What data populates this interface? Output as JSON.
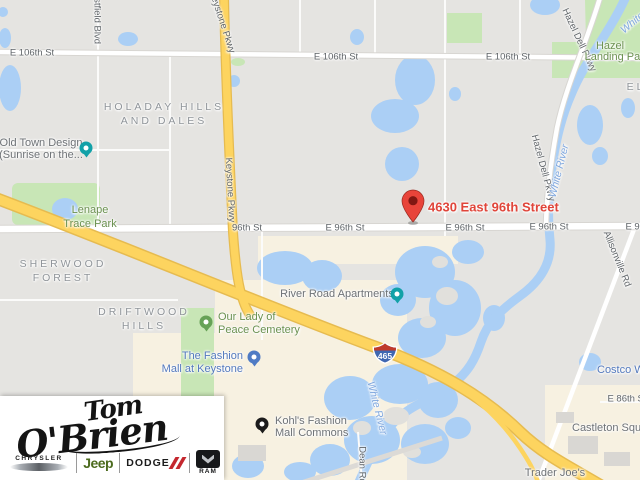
{
  "map": {
    "marker": {
      "address": "4630 East 96th Street"
    },
    "streets": {
      "e_106th": "E 106th St",
      "e_96th": "E 96th St",
      "s_96th": "96th St",
      "e_86th": "E 86th St",
      "keystone_pkwy": "Keystone Pkwy",
      "hazel_dell_pkwy": "Hazel Dell Pkwy",
      "westfield_blvd": "Westfield Blvd",
      "allisonville_rd": "Allisonville Rd",
      "dean_rd": "Dean Rd",
      "i465": "465"
    },
    "areas": {
      "holaday_line1": "HOLADAY HILLS",
      "holaday_line2": "AND DALES",
      "sherwood_line1": "SHERWOOD",
      "sherwood_line2": "FOREST",
      "driftwood_line1": "DRIFTWOOD",
      "driftwood_line2": "HILLS",
      "partial_east": "EL"
    },
    "parks": {
      "lenape_line1": "Lenape",
      "lenape_line2": "Trace Park",
      "hazel_landing_line1": "Hazel",
      "hazel_landing_line2": "Landing Park",
      "cemetery_line1": "Our Lady of",
      "cemetery_line2": "Peace Cemetery"
    },
    "pois": {
      "old_town_line1": "Old Town Design",
      "old_town_line2": "(Sunrise on the...",
      "river_road_apartments": "River Road Apartments",
      "fashion_mall_line1": "The Fashion",
      "fashion_mall_line2": "Mall at Keystone",
      "kohls_line1": "Kohl's Fashion",
      "kohls_line2": "Mall Commons",
      "castleton_square": "Castleton Square",
      "trader_joes": "Trader Joe's",
      "costco": "Costco Wholesale"
    },
    "water_label": "White River"
  },
  "logo": {
    "signature_line1": "Tom",
    "signature_line2": "O'Brien",
    "brands": {
      "chrysler": "CHRYSLER",
      "jeep": "Jeep",
      "dodge": "DODGE",
      "ram": "RAM"
    }
  },
  "colors": {
    "marker_red": "#e8443a",
    "highway_yellow": "#fdd45f",
    "water_blue": "#abcff5",
    "park_green": "#c8e6b6",
    "commercial_cream": "#f7f1e1",
    "jeep_green": "#4c6b1e",
    "dodge_red": "#c4272e"
  }
}
